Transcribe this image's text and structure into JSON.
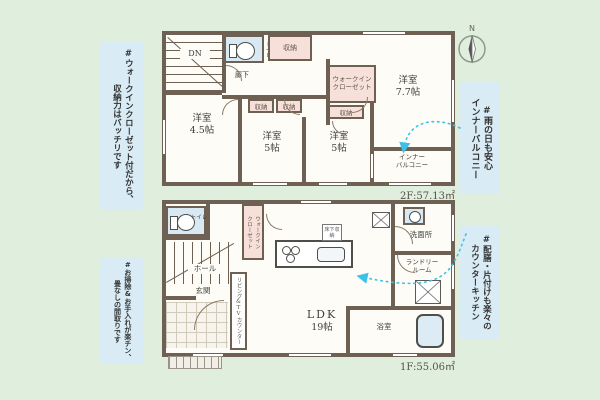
{
  "colors": {
    "background": "#e0eedd",
    "annotation_card": "#d9ecf6",
    "wall": "#6e6052",
    "closet_pink": "#f7e0d9",
    "fixture_blue": "#d8e9f3",
    "arrow": "#3ec1e8"
  },
  "annotations": {
    "top_left": [
      "#ウォークインクローゼット付だから、",
      "収納力はバッチリです"
    ],
    "bottom_left": [
      "#お掃除&お手入れが楽チン、",
      "畳なしの間取りです"
    ],
    "top_right": [
      "#雨の日も安心",
      "インナーバルコニー"
    ],
    "bottom_right": [
      "#配膳・片付けも楽々の",
      "カウンターキッチン"
    ]
  },
  "compass": {
    "north": "N"
  },
  "floor2": {
    "area": "2F:57.13㎡",
    "stairs_label": "DN",
    "hallway": "廊下",
    "toilet": "トイレ",
    "closet_top": "収納",
    "closet_wic_side": "収納",
    "closet_a": "収納",
    "closet_b": "収納",
    "wic": [
      "ウォークイン",
      "クローゼット"
    ],
    "rooms": {
      "main": {
        "name": "洋室",
        "size": "7.7帖"
      },
      "west": {
        "name": "洋室",
        "size": "4.5帖"
      },
      "center": {
        "name": "洋室",
        "size": "5帖"
      },
      "east": {
        "name": "洋室",
        "size": "5帖"
      }
    },
    "balcony": [
      "インナー",
      "バルコニー"
    ]
  },
  "floor1": {
    "area": "1F:55.06㎡",
    "stairs_label": "UP",
    "toilet": "トイレ",
    "hall": "ホール",
    "entrance": "玄関",
    "wic": [
      "ウォークイン",
      "クローゼット"
    ],
    "tv_counter": "リビング&TVカウンター",
    "ldk": {
      "name": "LDK",
      "size": "19帖"
    },
    "underfloor_storage": "床下収納",
    "washroom": "洗面所",
    "laundry": [
      "ランドリー",
      "ルーム"
    ],
    "bath": "浴室"
  }
}
